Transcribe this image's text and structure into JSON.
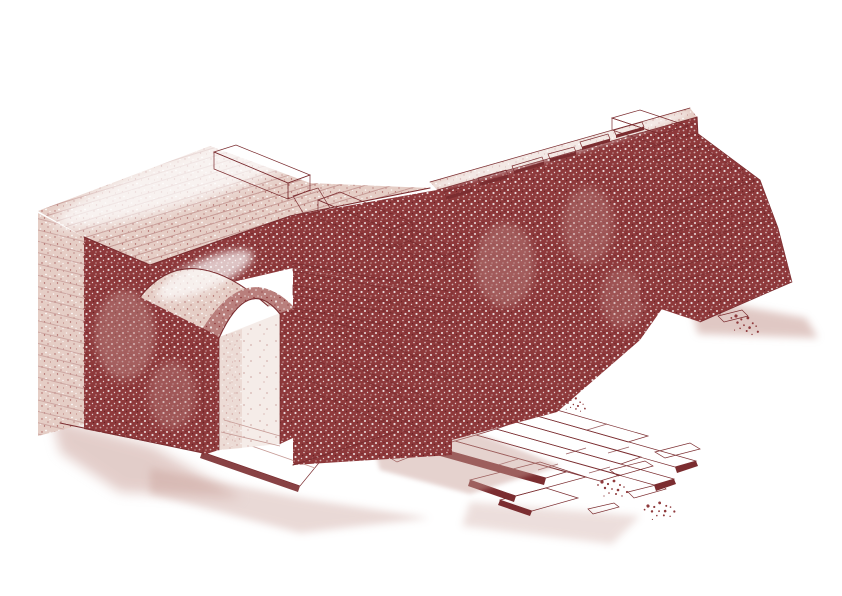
{
  "illustration": {
    "alt": "Axonometric cutaway reconstruction drawing, engraved stipple style in brick red on white: a barrel-vaulted passage pierces a thick masonry wall at left; a long ruined wall with stepped broken courses and thin projecting slabs recedes to the upper right, ending in a collapsed stepped stump with rubble; a paved slab walkway leads out of the vaulted doorway and breaks apart into scattered slabs and rubble toward the lower right.",
    "style": "monochrome stipple engraving",
    "parts": {
      "left_pier": "tall masonry pier with light hatched top surface",
      "vault": "barrel vault with arched doorway and lit interior passage",
      "middle_block": "coursed masonry block with stepped broken courses",
      "cap_blocks": "long pale capping stones laid across the wall top",
      "main_wall": "long stippled wall with stepped top and projecting thin slabs",
      "right_ruin": "stepped collapsed end of the wall with rubble and shadow",
      "pavement": "stone slab walkway breaking into fragments",
      "rubble": "scattered stone debris"
    }
  },
  "colors": {
    "dark": "#8e393b",
    "mid": "#b97f7c",
    "light": "#e5cdc5",
    "vlight": "#f5ece8",
    "line": "#7b2d30",
    "hatch": "#c69a95",
    "shadow": "#c79c94",
    "bg": "#ffffff",
    "hi": "#ffffff"
  }
}
